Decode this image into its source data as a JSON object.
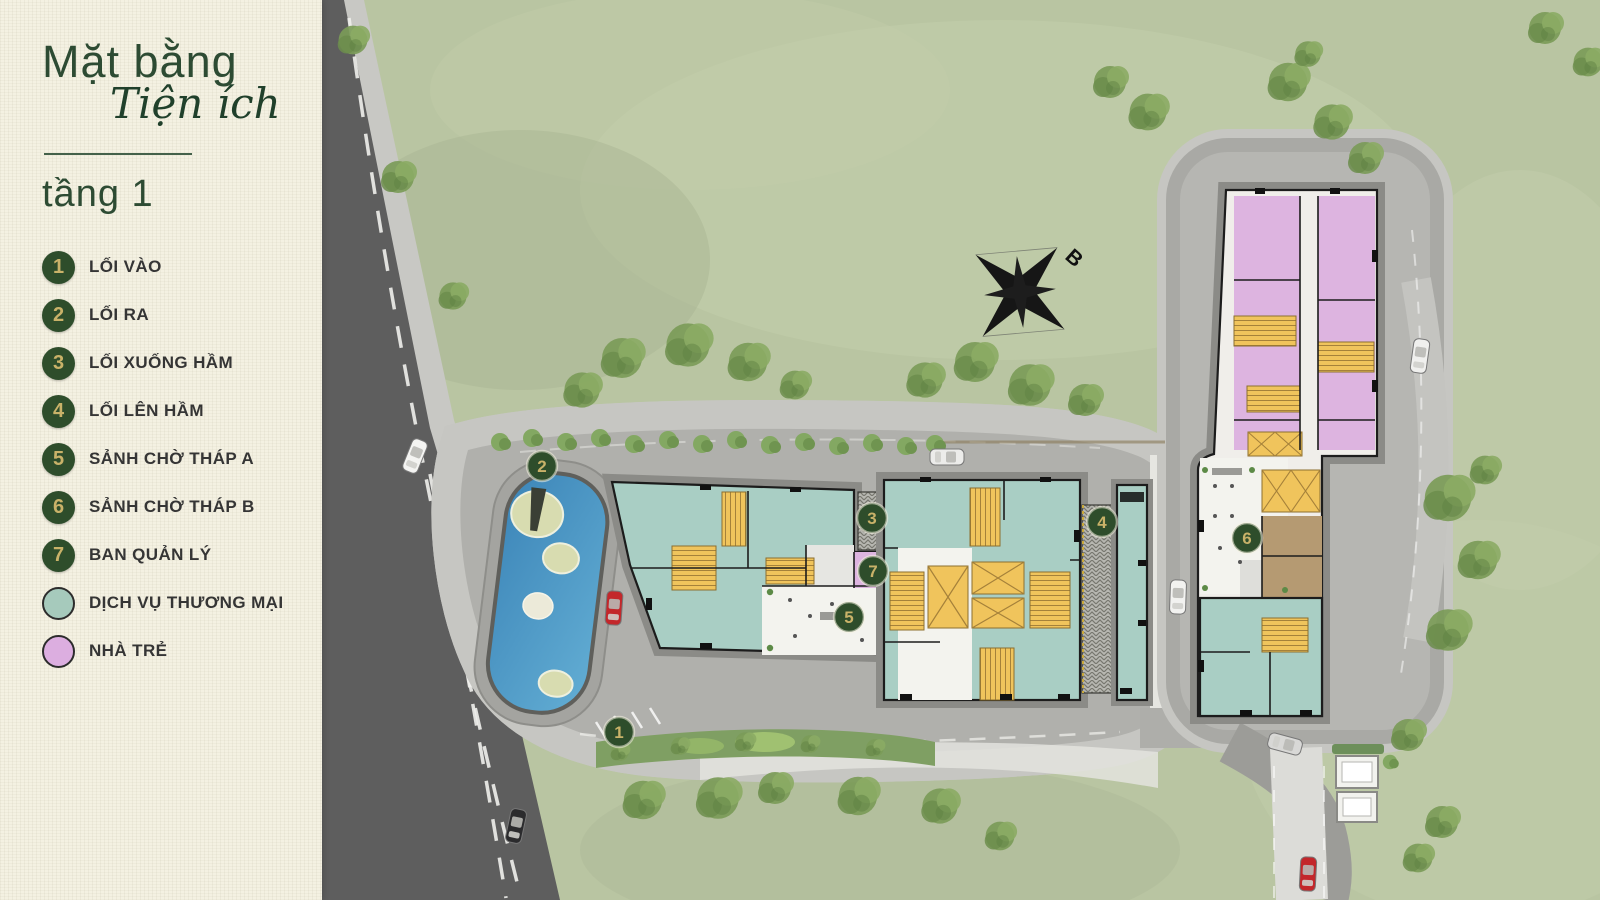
{
  "panel": {
    "title_line1": "Mặt bằng",
    "title_line2": "Tiện ích",
    "subtitle": "tầng 1"
  },
  "legend": {
    "numbered": [
      {
        "num": "1",
        "label": "LỐI VÀO"
      },
      {
        "num": "2",
        "label": "LỐI RA"
      },
      {
        "num": "3",
        "label": "LỐI XUỐNG HẦM"
      },
      {
        "num": "4",
        "label": "LỐI LÊN HẦM"
      },
      {
        "num": "5",
        "label": "SẢNH CHỜ THÁP A"
      },
      {
        "num": "6",
        "label": "SẢNH CHỜ THÁP B"
      },
      {
        "num": "7",
        "label": "BAN QUẢN LÝ"
      }
    ],
    "swatches": [
      {
        "color": "#a6cabc",
        "label": "DỊCH VỤ THƯƠNG MẠI"
      },
      {
        "color": "#dcaee0",
        "label": "NHÀ TRẺ"
      }
    ]
  },
  "map": {
    "compass_label": "B",
    "markers": [
      {
        "num": "1",
        "x": 619,
        "y": 732
      },
      {
        "num": "2",
        "x": 542,
        "y": 466
      },
      {
        "num": "3",
        "x": 872,
        "y": 518
      },
      {
        "num": "4",
        "x": 1102,
        "y": 522
      },
      {
        "num": "5",
        "x": 849,
        "y": 617
      },
      {
        "num": "6",
        "x": 1247,
        "y": 538
      },
      {
        "num": "7",
        "x": 873,
        "y": 571
      }
    ],
    "colors": {
      "marker_bg": "#2e4d2b",
      "marker_num": "#c9b269",
      "service_teal": "#a6cabc",
      "kindergarten_pink": "#dcaee0",
      "core_yellow": "#f0c45c",
      "grass": "#b9c5a2",
      "road_dark": "#5e5e5e",
      "road_light": "#a9a9a5",
      "sidewalk": "#c6c6c2",
      "pool_blue": "#4a93c1",
      "panel_bg": "#f4f1e2",
      "title_green": "#2d4b33"
    }
  }
}
